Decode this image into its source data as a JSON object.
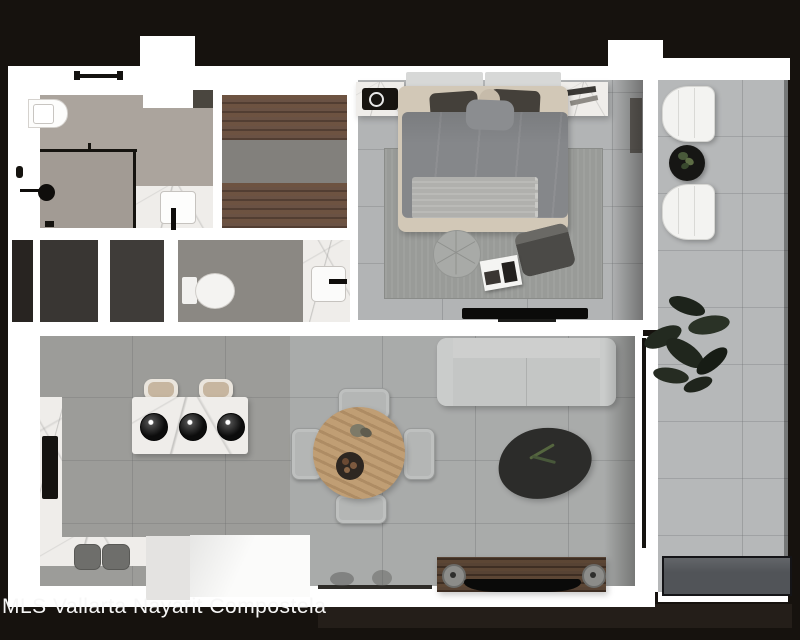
{
  "watermark": {
    "text": "MLS Vallarta Nayarit Compostela"
  },
  "scene": {
    "kind": "apartment-floor-plan-top-view-render",
    "rooms": [
      {
        "name": "bathroom-1",
        "furniture": [
          "toilet",
          "walk-in shower",
          "rain shower head",
          "glass partition",
          "towel bar",
          "marble vanity with square sink and black faucet"
        ]
      },
      {
        "name": "walk-in-closet",
        "furniture": [
          "wood wardrobe upper run",
          "wood wardrobe lower run"
        ]
      },
      {
        "name": "storage-closet-1",
        "furniture": []
      },
      {
        "name": "storage-closet-2",
        "furniture": []
      },
      {
        "name": "bathroom-2",
        "furniture": [
          "toilet",
          "marble vanity with square sink and black faucet"
        ]
      },
      {
        "name": "bedroom",
        "furniture": [
          "double bed with gray duvet",
          "two dark pillows",
          "round ball pillow",
          "light throw blanket",
          "left nightstand with black speaker",
          "right nightstand with books",
          "area rug",
          "round pouf",
          "dark floor cushion",
          "magazine",
          "wall-mounted tv"
        ]
      },
      {
        "name": "kitchen",
        "furniture": [
          "marble island with three burners",
          "two tan island stools",
          "left marble counter with black cooktop",
          "bottom marble counter",
          "two gray bar stools",
          "white cabinet block"
        ]
      },
      {
        "name": "dining-area",
        "furniture": [
          "round wood table",
          "four gray chairs",
          "centerpiece plant",
          "fruit bowl"
        ]
      },
      {
        "name": "living-room",
        "furniture": [
          "light gray sofa",
          "organic black coffee table with plant sprig",
          "wood tv console",
          "two round speakers",
          "black tv"
        ]
      },
      {
        "name": "balcony",
        "furniture": [
          "white lounge chair",
          "round black side table with plant",
          "white lounge chair",
          "large potted plant",
          "dark planter box"
        ]
      }
    ],
    "palette": {
      "background": "#16120e",
      "walls": "#ffffff",
      "bathroom_floor": "#aba49d",
      "closet_floor": "#82807c",
      "dark_rooms": "#393633",
      "bedroom_tile": "#b2b4b5",
      "living_tile": "#a9abaa",
      "kitchen_tile": "#9c9c99",
      "balcony_tile": "#b6b8b9",
      "wood": "#6a5244",
      "marble": "#efedea",
      "accent_black": "#0f0d0b"
    }
  }
}
